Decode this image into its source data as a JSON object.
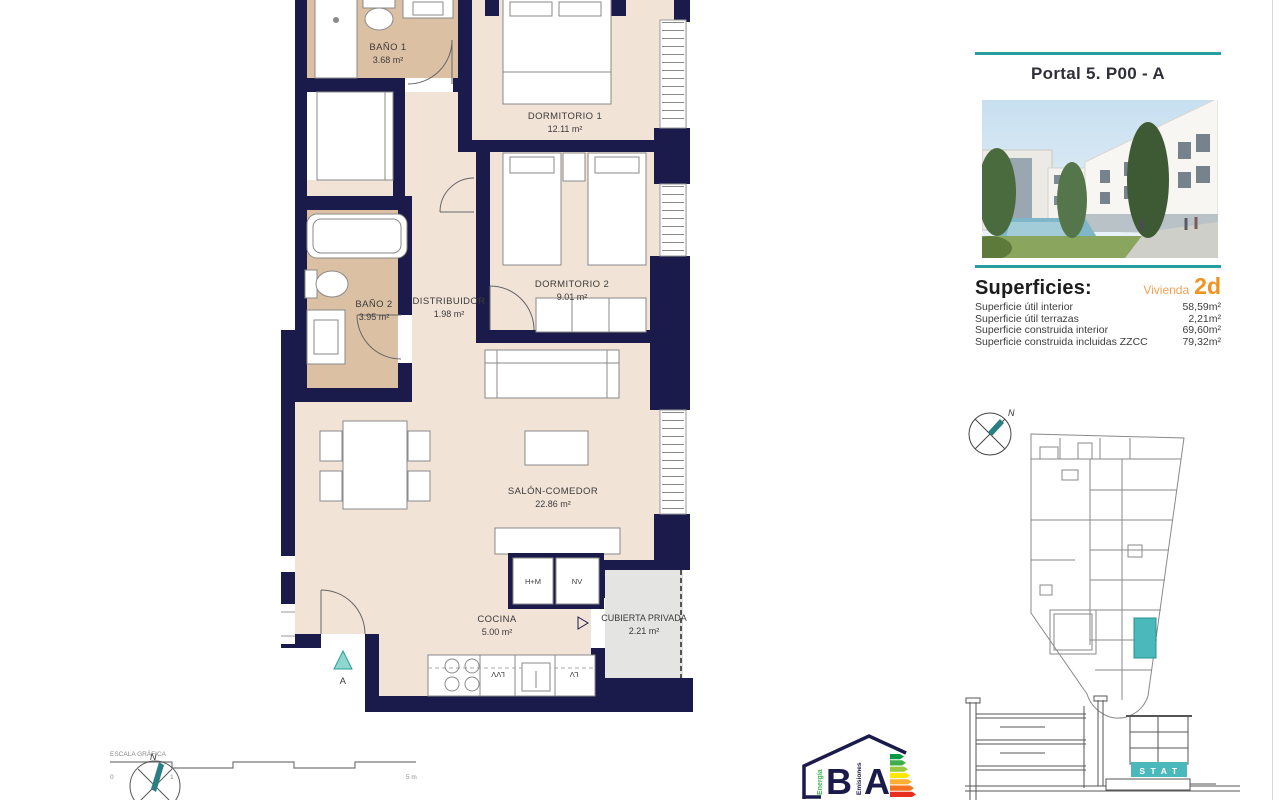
{
  "sheet": {
    "title": "Portal 5. P00 - A"
  },
  "superficies": {
    "heading": "Superficies:",
    "vivienda_label": "Vivienda",
    "vivienda_code": "2d",
    "rows": [
      {
        "label": "Superficie útil interior",
        "value": "58,59m²"
      },
      {
        "label": "Superficie útil terrazas",
        "value": "2,21m²"
      },
      {
        "label": "Superficie construida interior",
        "value": "69,60m²"
      },
      {
        "label": "Superficie construida incluidas ZZCC",
        "value": "79,32m²"
      }
    ]
  },
  "floorplan": {
    "rooms": [
      {
        "name": "BAÑO 1",
        "area": "3.68 m²"
      },
      {
        "name": "DORMITORIO 1",
        "area": "12.11 m²"
      },
      {
        "name": "DORMITORIO 2",
        "area": "9.01 m²"
      },
      {
        "name": "BAÑO 2",
        "area": "3.95 m²"
      },
      {
        "name": "DISTRIBUIDOR",
        "area": "1.98 m²"
      },
      {
        "name": "SALÓN-COMEDOR",
        "area": "22.86 m²"
      },
      {
        "name": "COCINA",
        "area": "5.00 m²"
      },
      {
        "name": "CUBIERTA PRIVADA",
        "area": "2.21 m²"
      }
    ],
    "appliances": {
      "oven_micro": "H+M",
      "fridge": "NV",
      "washer": "LVV",
      "dishwasher": "LV"
    },
    "entry_marker": "A"
  },
  "scale_bar": {
    "title": "ESCALA GRÁFICA",
    "ticks": [
      "0",
      "1",
      "5 m"
    ]
  },
  "compass": {
    "north": "N"
  },
  "site_section": {
    "highlight_label": "S T A T"
  },
  "energy_label": {
    "scale_letter_b": "B",
    "scale_letter_a": "A",
    "energia": "Energía",
    "emisiones": "Emisiones"
  },
  "colors": {
    "wall": "#1b1b4b",
    "floor": "#f2e3d7",
    "bath_floor": "#dcc0a4",
    "accent_teal": "#2a9d9d",
    "highlight_teal": "#4bb8bc",
    "accent_orange": "#f0941f",
    "terrace_gray": "#e4e4e2"
  }
}
